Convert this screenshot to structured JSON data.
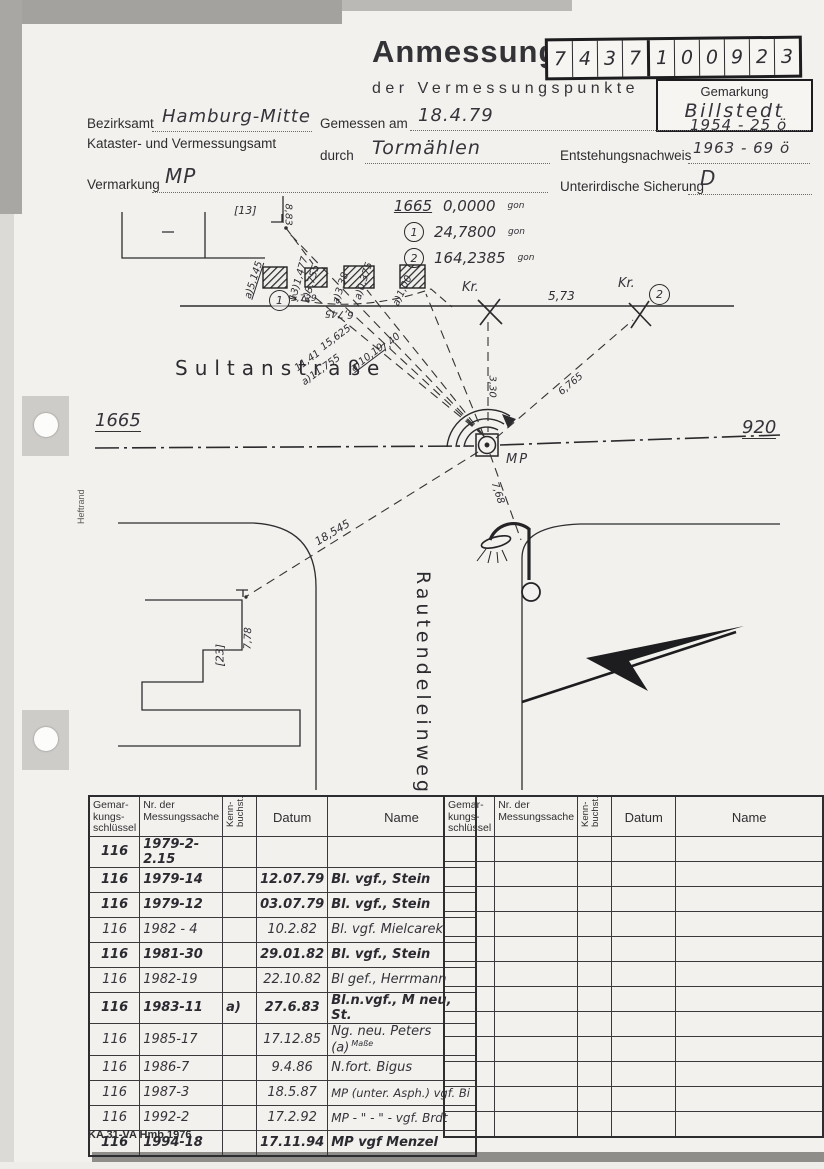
{
  "header": {
    "title": "Anmessung",
    "subtitle": "der Vermessungspunkte",
    "code_digits": [
      "7",
      "4",
      "3",
      "7",
      "1",
      "0",
      "0",
      "9",
      "2",
      "3"
    ],
    "gemarkung": {
      "label": "Gemarkung",
      "value": "Billstedt"
    },
    "fields": {
      "bezirksamt_label": "Bezirksamt",
      "bezirksamt_value": "Hamburg-Mitte",
      "amt_label": "Kataster- und Vermessungsamt",
      "gemessen_label": "Gemessen am",
      "gemessen_value": "18.4.79",
      "durch_label": "durch",
      "durch_value": "Tormählen",
      "entstehung_value_top": "1954 - 25 ö",
      "entstehung_label": "Entstehungsnachweis",
      "entstehung_value": "1963 - 69 ö",
      "vermarkung_label": "Vermarkung",
      "vermarkung_value": "MP",
      "sicherung_label": "Unterirdische Sicherung",
      "sicherung_value": "D"
    }
  },
  "sketch": {
    "angle_list": [
      {
        "ref": "1665",
        "value": "0,0000",
        "unit": "gon"
      },
      {
        "ref": "1",
        "value": "24,7800",
        "unit": "gon"
      },
      {
        "ref": "2",
        "value": "164,2385",
        "unit": "gon"
      }
    ],
    "labels": {
      "street1": "Sultanstraße",
      "street2": "Rautendeleinweg",
      "point_left": "1665",
      "point_right": "920",
      "mp": "MP",
      "kr1": "Kr.",
      "kr2": "Kr.",
      "circle1": "1",
      "circle2": "2",
      "house13": "[13]",
      "house23": "[23]",
      "heftrand": "Heftrand"
    },
    "measurements": {
      "m883": "8,83",
      "m5145": "a)5,145",
      "m1477": "13)1,477",
      "m3755": "3)3,755",
      "m338": "a)3,38",
      "m0375": "a)0,375",
      "m100": "a)1,00",
      "m5729": "5,729",
      "m6745": "6,745",
      "m573": "5,73",
      "m15625": "15,625",
      "m740": "7,40",
      "m1141": "11,41",
      "m11755": "a)11,755",
      "m1019": "a)10,19",
      "m330": "3,30",
      "m6765": "6,765",
      "m768": "7,68",
      "m18545": "18,545",
      "m778": "7,78"
    }
  },
  "table": {
    "headers": [
      "Gemar-\nkungs-\nschlüssel",
      "Nr. der\nMessungssache",
      "Kenn-\nbuchst.",
      "Datum",
      "Name"
    ],
    "rows": [
      {
        "key": "116",
        "nr": "1979-2-2.15",
        "kenn": "",
        "datum": "",
        "name": ""
      },
      {
        "key": "116",
        "nr": "1979-14",
        "kenn": "",
        "datum": "12.07.79",
        "name": "Bl. vgf., Stein"
      },
      {
        "key": "116",
        "nr": "1979-12",
        "kenn": "",
        "datum": "03.07.79",
        "name": "Bl. vgf., Stein"
      },
      {
        "key": "116",
        "nr": "1982 - 4",
        "kenn": "",
        "datum": "10.2.82",
        "name": "Bl. vgf. Mielcarek"
      },
      {
        "key": "116",
        "nr": "1981-30",
        "kenn": "",
        "datum": "29.01.82",
        "name": "Bl. vgf., Stein"
      },
      {
        "key": "116",
        "nr": "1982-19",
        "kenn": "",
        "datum": "22.10.82",
        "name": "Bl gef., Herrmann"
      },
      {
        "key": "116",
        "nr": "1983-11",
        "kenn": "a)",
        "datum": "27.6.83",
        "name": "Bl.n.vgf., M neu, St."
      },
      {
        "key": "116",
        "nr": "1985-17",
        "kenn": "",
        "datum": "17.12.85",
        "name": "Ng. neu. Peters (a)",
        "note": "Maße"
      },
      {
        "key": "116",
        "nr": "1986-7",
        "kenn": "",
        "datum": "9.4.86",
        "name": "N.fort. Bigus"
      },
      {
        "key": "116",
        "nr": "1987-3",
        "kenn": "",
        "datum": "18.5.87",
        "name": "MP (unter. Asph.) vgf. Bi"
      },
      {
        "key": "116",
        "nr": "1992-2",
        "kenn": "",
        "datum": "17.2.92",
        "name": "MP - \" - \" - vgf. Brdt"
      },
      {
        "key": "116",
        "nr": "1994-18",
        "kenn": "",
        "datum": "17.11.94",
        "name": "MP vgf  Menzel"
      }
    ]
  },
  "footer": "KA 31-VA Hmb 1976"
}
